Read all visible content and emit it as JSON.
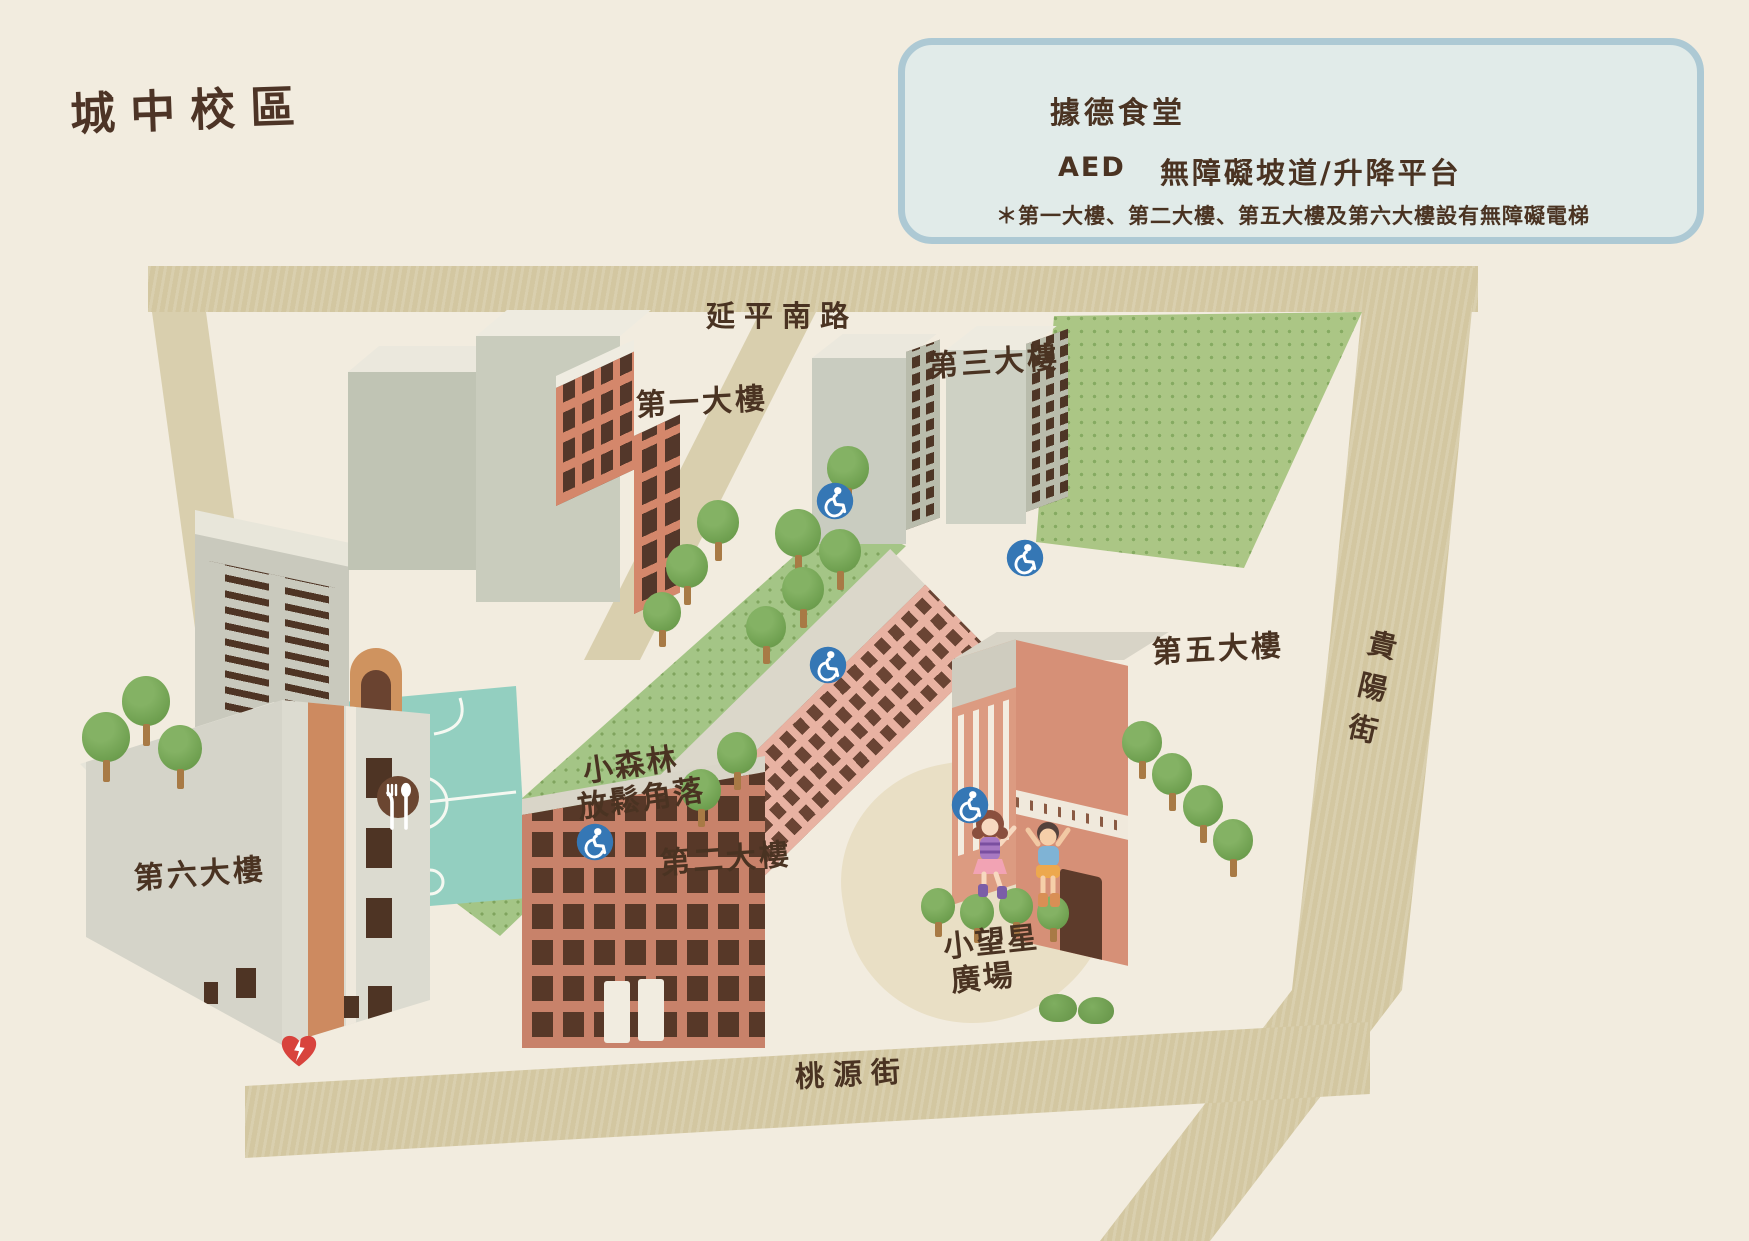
{
  "title": "城中校區",
  "legend": {
    "canteen": "據德食堂",
    "aed": "AED",
    "accessible": "無障礙坡道/升降平台",
    "footnote": "＊第一大樓、第二大樓、第五大樓及第六大樓設有無障礙電梯"
  },
  "streets": {
    "north": "延平南路",
    "east": "貴陽街",
    "south": "桃源街"
  },
  "buildings": {
    "b1": "第一大樓",
    "b2": "第二大樓",
    "b3": "第三大樓",
    "b5": "第五大樓",
    "b6": "第六大樓"
  },
  "areas": {
    "forest": [
      "小森林",
      "放鬆角落"
    ],
    "plaza": [
      "小望星",
      "廣場"
    ]
  },
  "colors": {
    "background": "#f2ecdf",
    "street": "#d3c7a1",
    "ink": "#4a3322",
    "legend_bg": "#e1ebe9",
    "legend_border": "#adc9d4",
    "accessible_blue": "#3577b5",
    "aed_red": "#d8433d",
    "canteen_brown": "#6b4631",
    "grass": "#abc685",
    "court_teal": "#93cfc0",
    "building_pink": "#e8b2a2",
    "building_grey": "#c9ccbd",
    "building_salmon": "#d4876b"
  },
  "markers": {
    "wheelchair_points": [
      {
        "x": 835,
        "y": 501
      },
      {
        "x": 1025,
        "y": 558
      },
      {
        "x": 828,
        "y": 665
      },
      {
        "x": 970,
        "y": 805
      },
      {
        "x": 595,
        "y": 842
      }
    ],
    "canteen_point": {
      "x": 398,
      "y": 798
    },
    "aed_point": {
      "x": 299,
      "y": 1052
    },
    "wheelchair_size": 38,
    "canteen_size": 44,
    "aed_size": 42
  },
  "legend_icons": [
    {
      "type": "canteen",
      "x": 1020,
      "y": 102,
      "size": 40
    },
    {
      "type": "aed",
      "x": 1027,
      "y": 166,
      "size": 44
    },
    {
      "type": "wheelchair",
      "x": 1130,
      "y": 167,
      "size": 37
    }
  ],
  "trees": [
    {
      "x": 848,
      "y": 468,
      "r": 21
    },
    {
      "x": 798,
      "y": 533,
      "r": 23
    },
    {
      "x": 718,
      "y": 522,
      "r": 21
    },
    {
      "x": 687,
      "y": 566,
      "r": 21
    },
    {
      "x": 662,
      "y": 612,
      "r": 19
    },
    {
      "x": 840,
      "y": 551,
      "r": 21
    },
    {
      "x": 803,
      "y": 589,
      "r": 21
    },
    {
      "x": 766,
      "y": 627,
      "r": 20
    },
    {
      "x": 737,
      "y": 753,
      "r": 20
    },
    {
      "x": 701,
      "y": 790,
      "r": 20
    },
    {
      "x": 106,
      "y": 737,
      "r": 24
    },
    {
      "x": 146,
      "y": 701,
      "r": 24
    },
    {
      "x": 180,
      "y": 748,
      "r": 22
    },
    {
      "x": 1142,
      "y": 742,
      "r": 20
    },
    {
      "x": 1172,
      "y": 774,
      "r": 20
    },
    {
      "x": 1203,
      "y": 806,
      "r": 20
    },
    {
      "x": 1233,
      "y": 840,
      "r": 20
    },
    {
      "x": 938,
      "y": 906,
      "r": 17
    },
    {
      "x": 977,
      "y": 912,
      "r": 17
    },
    {
      "x": 1016,
      "y": 906,
      "r": 17
    },
    {
      "x": 1053,
      "y": 913,
      "r": 16
    }
  ],
  "bushes": [
    {
      "x": 1058,
      "y": 1008,
      "r": 19
    },
    {
      "x": 1096,
      "y": 1010,
      "r": 18
    }
  ]
}
